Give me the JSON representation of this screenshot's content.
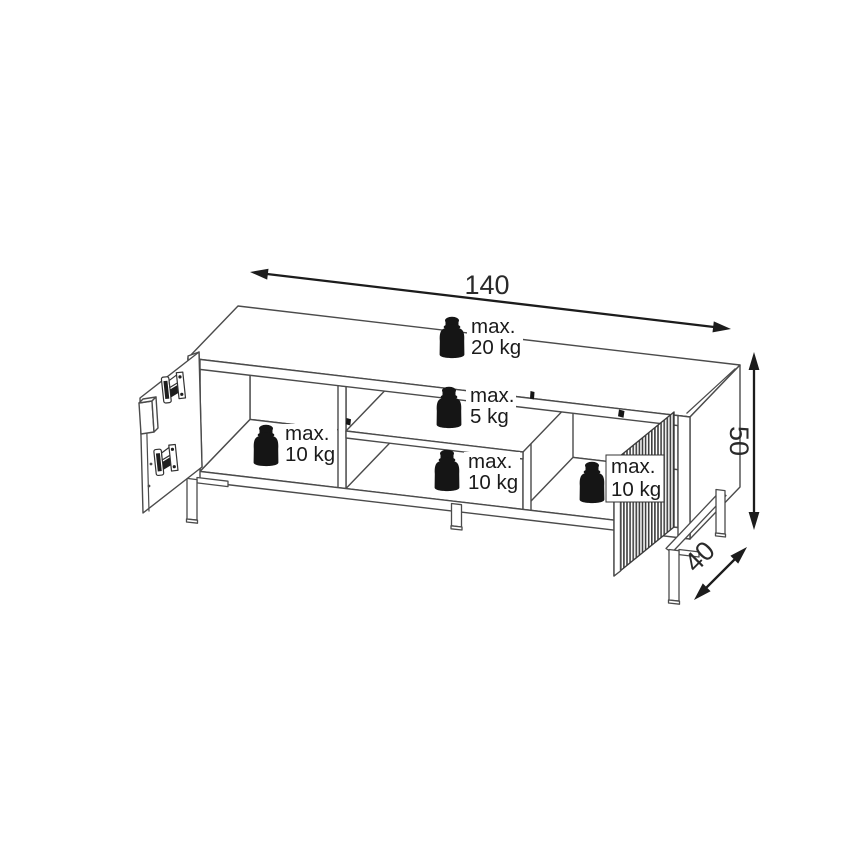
{
  "diagram": {
    "dimension_labels": {
      "width": "140",
      "height": "50",
      "depth": "40"
    },
    "load_labels": [
      {
        "location": "top-surface",
        "line1": "max.",
        "line2": "20 kg"
      },
      {
        "location": "middle-shelf",
        "line1": "max.",
        "line2": "5 kg"
      },
      {
        "location": "left-compartment",
        "line1": "max.",
        "line2": "10 kg"
      },
      {
        "location": "middle-lower-shelf",
        "line1": "max.",
        "line2": "10 kg"
      },
      {
        "location": "right-compartment",
        "line1": "max.",
        "line2": "10 kg"
      }
    ],
    "colors": {
      "background": "#ffffff",
      "drawing_line": "#4b4b4b",
      "dimension_line": "#1c1c1c",
      "weight_icon": "#151515",
      "label_text": "#1b1b1b"
    }
  }
}
